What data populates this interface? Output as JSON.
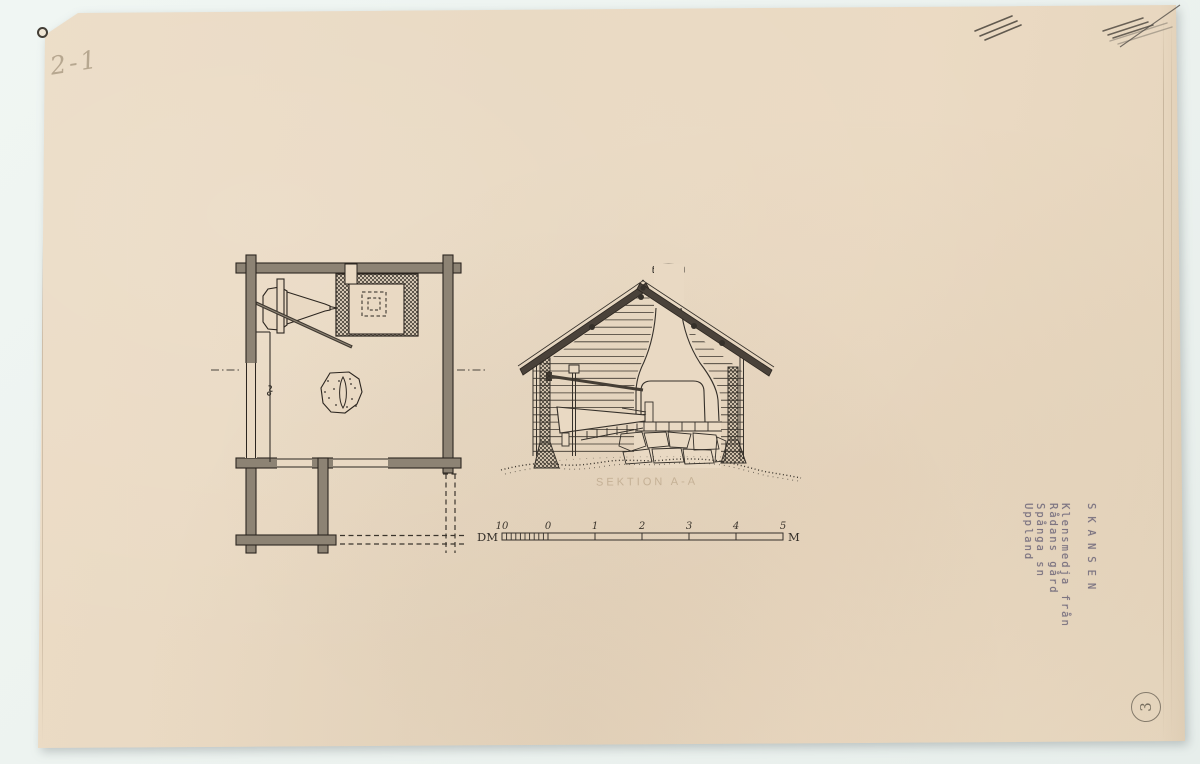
{
  "document": {
    "pencil_note": "2-1",
    "sheet_number": "3",
    "stamp": {
      "title": "SKANSEN",
      "lines": [
        "Klensmedja från",
        "Rådans gård",
        "Spånga sn",
        "Uppland"
      ]
    },
    "section_caption": "SEKTION A-A",
    "scalebar": {
      "unit_left": "DM",
      "unit_right": "M",
      "labels": [
        "10",
        "0",
        "1",
        "2",
        "3",
        "4",
        "5"
      ]
    },
    "colors": {
      "background": "#eef4f1",
      "paper": "#e9d9c3",
      "ink": "#35302a",
      "wall_fill": "#8d8374",
      "roof_fill": "#4a423a",
      "stamp_ink": "#6f6878",
      "pencil": "#8a7a60"
    }
  }
}
